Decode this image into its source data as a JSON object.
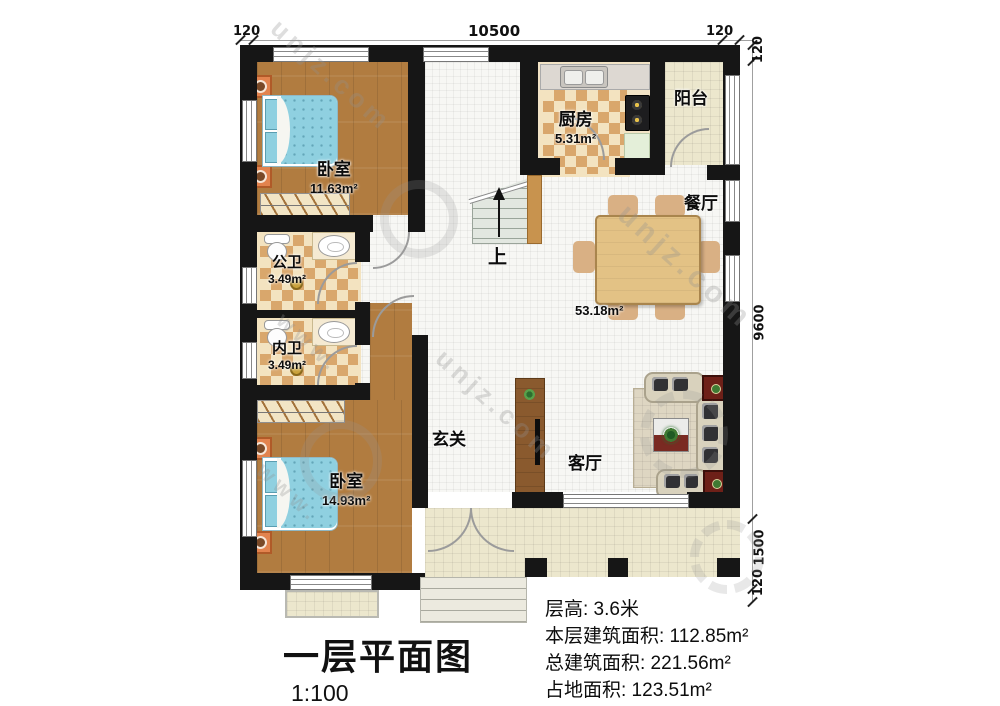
{
  "title": {
    "text": "一层平面图",
    "scale": "1:100"
  },
  "info": {
    "line1": "层高: 3.6米",
    "line2": "本层建筑面积: 112.85m²",
    "line3": "总建筑面积: 221.56m²",
    "line4": "占地面积: 123.51m²"
  },
  "dimensions": {
    "top_left": "120",
    "top_width": "10500",
    "top_right": "120",
    "right_top": "120",
    "right_main": "9600",
    "right_terrace": "1500",
    "right_bottom": "120"
  },
  "rooms": {
    "bedroom1": {
      "label": "卧室",
      "area": "11.63m²"
    },
    "kitchen": {
      "label": "厨房",
      "area": "5.31m²"
    },
    "balcony": {
      "label": "阳台"
    },
    "dining": {
      "label": "餐厅"
    },
    "public_bath": {
      "label": "公卫",
      "area": "3.49m²"
    },
    "private_bath": {
      "label": "内卫",
      "area": "3.49m²"
    },
    "bedroom2": {
      "label": "卧室",
      "area": "14.93m²"
    },
    "entry": {
      "label": "玄关"
    },
    "living": {
      "label": "客厅"
    },
    "open_area": {
      "area": "53.18m²"
    },
    "stairs": {
      "label": "上"
    }
  },
  "watermark": {
    "text": "unjz.com",
    "text2": "www."
  },
  "colors": {
    "wall": "#161616",
    "wood_floor": "#b17c40",
    "checker_tan": "#d9a76c",
    "checker_cream": "#f3e3c0",
    "tile_white": "#f7f7f4",
    "tile_cream": "#ece7cd",
    "bed_blue": "#8fd0e0",
    "nightstand_orange": "#e2834e",
    "table_wood": "#e3c285",
    "sofa_beige": "#d9d2bd",
    "accent_red": "#6e2018"
  }
}
